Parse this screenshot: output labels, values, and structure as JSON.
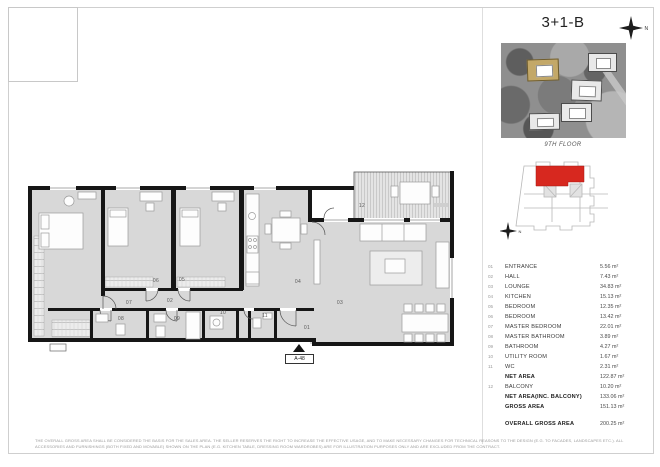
{
  "header": {
    "title": "3+1-B",
    "compass_label": "N"
  },
  "key_plan": {
    "floor_label": "9TH FLOOR",
    "highlight_color": "#d7281f",
    "compass_label": "N"
  },
  "plan": {
    "unit_label": "A-48",
    "rooms": [
      {
        "no": "01"
      },
      {
        "no": "02"
      },
      {
        "no": "03"
      },
      {
        "no": "04"
      },
      {
        "no": "05"
      },
      {
        "no": "06"
      },
      {
        "no": "07"
      },
      {
        "no": "08"
      },
      {
        "no": "09"
      },
      {
        "no": "10"
      },
      {
        "no": "11"
      },
      {
        "no": "12"
      }
    ]
  },
  "legend": {
    "rows": [
      {
        "no": "01",
        "name": "ENTRANCE",
        "area": "5.56 m²"
      },
      {
        "no": "02",
        "name": "HALL",
        "area": "7.43 m²"
      },
      {
        "no": "03",
        "name": "LOUNGE",
        "area": "34.83 m²"
      },
      {
        "no": "04",
        "name": "KITCHEN",
        "area": "15.13 m²"
      },
      {
        "no": "05",
        "name": "BEDROOM",
        "area": "12.35 m²"
      },
      {
        "no": "06",
        "name": "BEDROOM",
        "area": "13.42 m²"
      },
      {
        "no": "07",
        "name": "MASTER BEDROOM",
        "area": "22.01 m²"
      },
      {
        "no": "08",
        "name": "MASTER BATHROOM",
        "area": "3.89 m²"
      },
      {
        "no": "09",
        "name": "BATHROOM",
        "area": "4.27 m²"
      },
      {
        "no": "10",
        "name": "UTILITY ROOM",
        "area": "1.67 m²"
      },
      {
        "no": "11",
        "name": "WC",
        "area": "2.31 m²"
      },
      {
        "no": "",
        "name": "NET AREA",
        "area": "122.87 m²"
      },
      {
        "no": "12",
        "name": "BALCONY",
        "area": "10.20 m²"
      },
      {
        "no": "",
        "name": "NET AREA(INC. BALCONY)",
        "area": "133.06 m²"
      },
      {
        "no": "",
        "name": "GROSS AREA",
        "area": "151.13 m²"
      },
      {
        "no": "",
        "name": "OVERALL GROSS AREA",
        "area": "200.25 m²"
      }
    ]
  },
  "disclaimer": "THE OVERALL GROSS AREA SHALL BE CONSIDERED THE BASIS FOR THE SALES AREA. THE SELLER RESERVES THE RIGHT TO INCREASE THE EFFECTIVE USAGE, AND TO MAKE NECESSARY CHANGES FOR TECHNICAL REASONS TO THE DESIGN (E.G. TO FACADES, LANDSCAPES ETC.). ALL ACCESSORIES AND FURNISHINGS (BOTH FIXED AND MOVABLE) SHOWN ON THE PLAN (E.G. KITCHEN TABLE, DRESSING ROOM WARDROBES) ARE FOR ILLUSTRATION PURPOSES ONLY AND ARE EXCLUDED FROM THE CONTRACT."
}
